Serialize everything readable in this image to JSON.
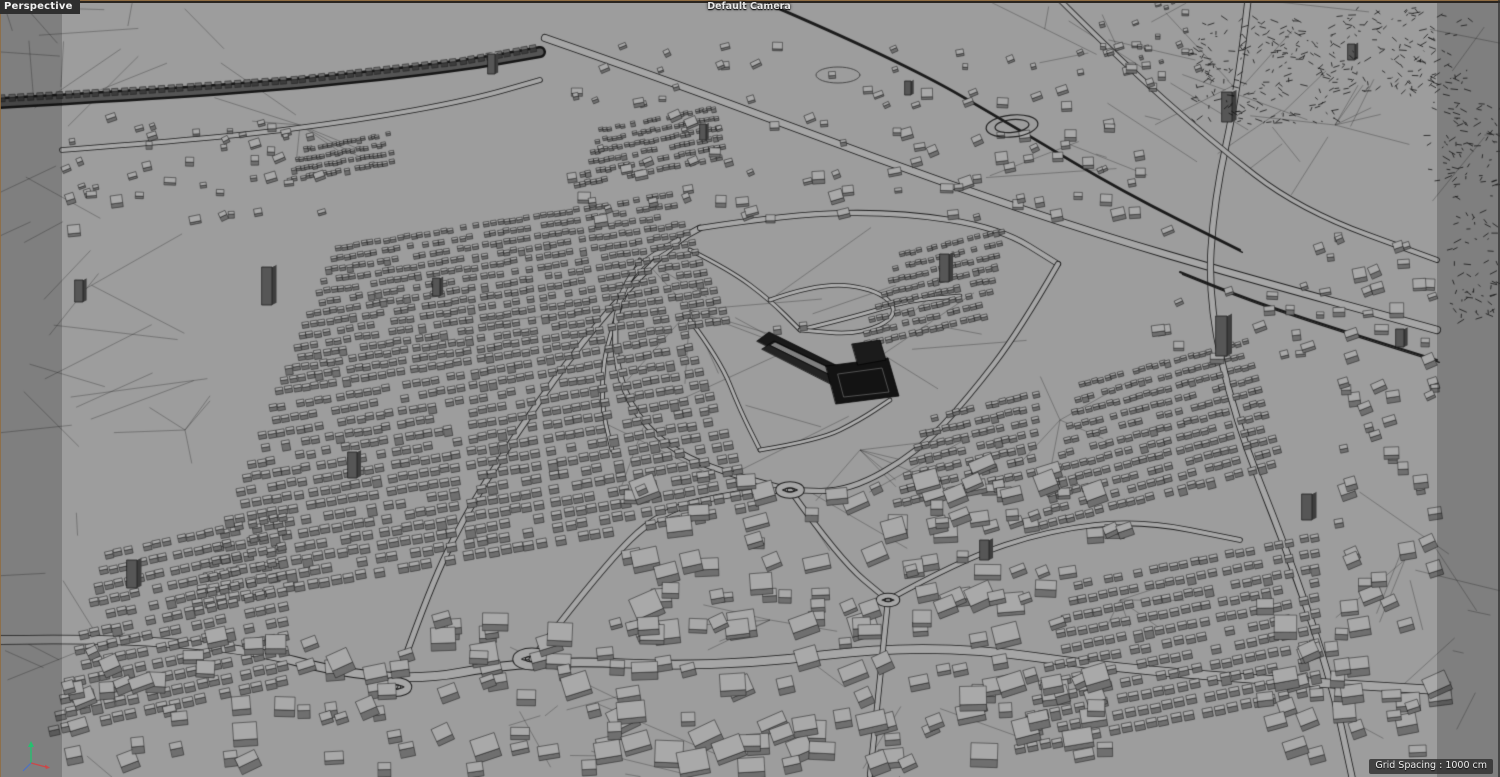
{
  "viewport": {
    "view_label": "Perspective",
    "camera_label": "Default Camera",
    "status": {
      "grid_spacing_label": "Grid Spacing : 1000 cm"
    }
  },
  "icons": {
    "world_axis_gizmo": "xyz-origin-axes-icon"
  },
  "colors": {
    "background": "#9d9d9d",
    "wire": "#1e1e1e",
    "mesh_line": "rgba(25,25,25,0.5)",
    "building_top": "#a9a9a9",
    "building_side": "#6f6f6f",
    "road_fill": "#a6a6a6",
    "path_fill": "#acacac",
    "viaduct_dark": "#161616",
    "viaduct_deck": "#555555",
    "landmark_dark": "#131313",
    "tower_front": "#565656",
    "tower_side": "#3e3e3e",
    "tower_top": "#a2a2a2",
    "woods_scrub": "rgba(18,18,18,0.85)",
    "overlay_shade": "rgba(12,12,12,0.20)",
    "frame_line": "#8f6c42",
    "edge_dark": "#2a2520",
    "label_text": "#f1f1f1",
    "label_bg": "#2f2f2f",
    "camera_text": "#e9e9e9",
    "axis_x": "#d84040",
    "axis_y": "#25c06f",
    "axis_z": "#3f6fd8"
  }
}
